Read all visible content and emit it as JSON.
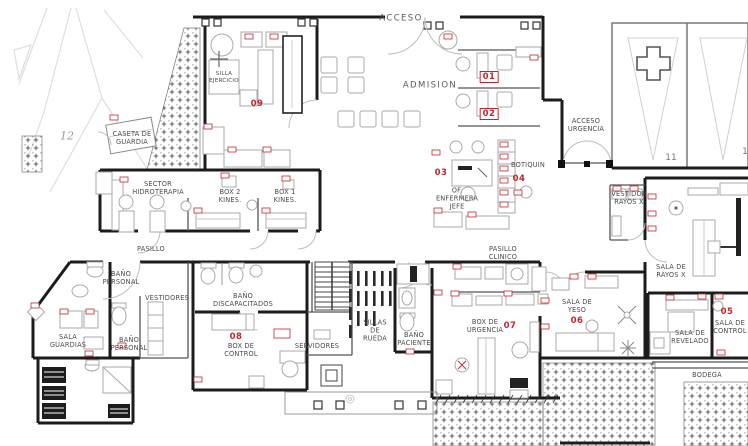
{
  "palette": {
    "background": "#ffffff",
    "wall": "#1c1c1c",
    "furniture_line": "#a9a9a9",
    "site_line": "#dedede",
    "accent_red": "#c1272d",
    "label_text": "#4a4a4a"
  },
  "labels": {
    "acceso": "ACCESO",
    "admision": "ADMISION",
    "acceso_urgencia": "ACCESO\nURGENCIA",
    "caseta_guardia": "CASETA DE\nGUARDIA",
    "silla_ejercicio": "SILLA\nEJERCICIO",
    "sector_hidroterapia": "SECTOR\nHIDROTERAPIA",
    "box2_kines": "BOX 2\nKINES.",
    "box1_kines": "BOX 1\nKINES.",
    "pasillo": "PASILLO",
    "of_enfermera_jefe": "OF.\nENFERMERA\nJEFE",
    "botiquin": "BOTIQUIN",
    "pasillo_clinico": "PASILLO\nCLINICO",
    "bano_personal_norte": "BAÑO\nPERSONAL",
    "vestidores": "VESTIDORES",
    "bano_discapacitados": "BAÑO\nDISCAPACITADOS",
    "sala_guardias": "SALA\nGUARDIAS",
    "bano_personal_sur": "BAÑO\nPERSONAL",
    "box_de_control": "BOX DE\nCONTROL",
    "servidores": "SERVIDORES",
    "sillas_de_rueda": "SILLAS\nDE\nRUEDA",
    "bano_paciente": "BAÑO\nPACIENTE",
    "box_de_urgencia": "BOX DE\nURGENCIA",
    "sala_de_yeso": "SALA DE\nYESO",
    "vestidor_rayos_x": "VESTIDOR\nRAYOS X",
    "sala_de_rayos_x": "SALA DE\nRAYOS X",
    "sala_de_revelado": "SALA DE\nREVELADO",
    "sala_de_control": "SALA DE\nCONTROL",
    "bodega": "BODEGA"
  },
  "markers": {
    "m01": "01",
    "m02": "02",
    "m03": "03",
    "m04": "04",
    "m05": "05",
    "m06": "06",
    "m07": "07",
    "m08": "08",
    "m09": "09"
  },
  "site_numbers": {
    "lot_left": "12",
    "lot_right": "11",
    "lot_edge": "1"
  }
}
